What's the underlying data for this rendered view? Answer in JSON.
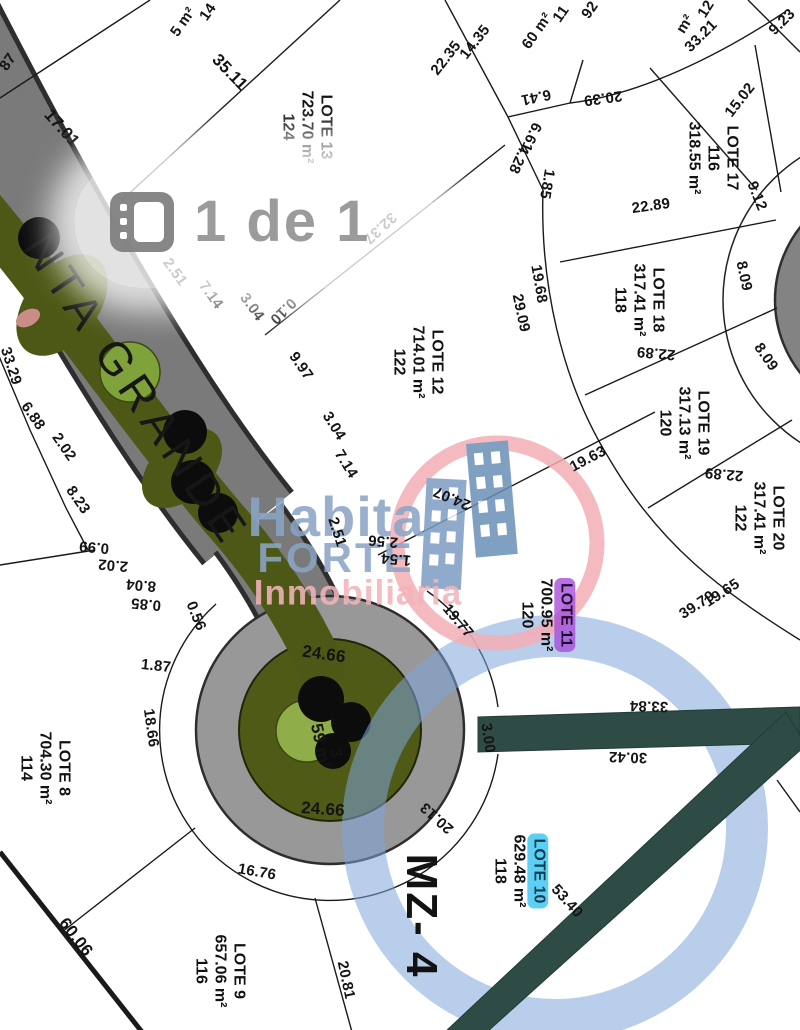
{
  "page": {
    "indicator": "1 de 1"
  },
  "street": "NTA GRANDE",
  "block": "MZ- 4",
  "watermark": {
    "l1": "Habita",
    "l2": "FORTE",
    "l3": "Inmobiliaria"
  },
  "lots": [
    {
      "name": "LOTE 8",
      "line2": "704.30 m²",
      "line3": "114",
      "highlight": "none"
    },
    {
      "name": "LOTE 9",
      "line2": "657.06 m²",
      "line3": "116",
      "highlight": "none"
    },
    {
      "name": "LOTE 10",
      "line2": "629.48 m²",
      "line3": "118",
      "highlight": "cyan"
    },
    {
      "name": "LOTE 11",
      "line2": "700.95 m²",
      "line3": "120",
      "highlight": "purple"
    },
    {
      "name": "LOTE 12",
      "line2": "714.01 m²",
      "line3": "122",
      "highlight": "none"
    },
    {
      "name": "LOTE 13",
      "line2": "723.70 m²",
      "line3": "124",
      "highlight": "none"
    },
    {
      "name": "LOTE 17",
      "line2": "116",
      "line3": "318.55 m²",
      "highlight": "none"
    },
    {
      "name": "LOTE 18",
      "line2": "317.41 m²",
      "line3": "118",
      "highlight": "none"
    },
    {
      "name": "LOTE 19",
      "line2": "317.13 m²",
      "line3": "120",
      "highlight": "none"
    },
    {
      "name": "LOTE 20",
      "line2": "317.41 m²",
      "line3": "122",
      "highlight": "none"
    }
  ],
  "m": [
    "87",
    "17.01",
    "35.11",
    "5 m²",
    "14",
    "7.43",
    "2.51",
    "7.14",
    "3.04",
    "32.37",
    "22.35",
    "14.35",
    "11",
    "60 m²",
    "92",
    "6.41",
    "20.39",
    "6.61",
    "4.28",
    "1.85",
    "12",
    "m²",
    "33.21",
    "9.23",
    "15.02",
    "22.89",
    "19.68",
    "29.09",
    "9.12",
    "8.09",
    "8.09",
    "22.89",
    "19.63",
    "22.89",
    "19.65",
    "39.79",
    "9.97",
    "3.04",
    "7.14",
    "24.07",
    "2.51",
    "2.56",
    "1.54",
    "19.77",
    "24.66",
    "59 m²",
    "3",
    "24.66",
    "20.13",
    "16.76",
    "18.66",
    "1.87",
    "0.56",
    "0.85",
    "8.04",
    "2.02",
    "0.99",
    "8.23",
    "2.02",
    "6.88",
    "33.29",
    "60.06",
    "20.81",
    "33.84",
    "30.42",
    "3.00",
    "53.40",
    "0.10"
  ],
  "colors": {
    "road_gray": "#7a7a7a",
    "median_green": "#52601a",
    "tree_black": "#0c0c0c",
    "tree_light_green": "#8fae4a",
    "teal_road": "#2e4b45",
    "highlight_blue_ring": "#7ea6d9",
    "highlight_purple": "#a855d6",
    "highlight_cyan": "#46c3f0",
    "watermark_blue": "#8ba5c6",
    "watermark_pink": "#f2b4ba",
    "page_indicator_gray": "#9b9b9b"
  }
}
